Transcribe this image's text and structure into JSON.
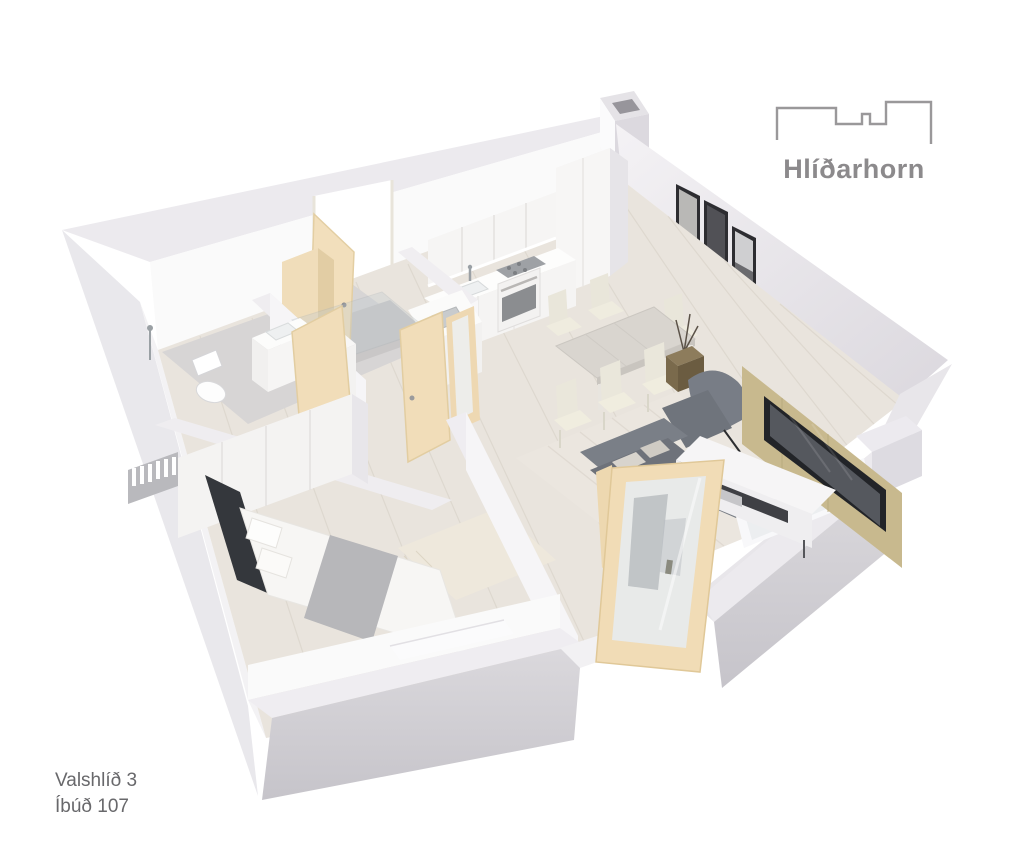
{
  "header": {
    "logo_text": "Hlíðarhorn"
  },
  "footer": {
    "address": "Valshlíð 3",
    "unit": "Íbúð 107"
  },
  "icons": {
    "logo_mark": "building-skyline-outline-icon"
  },
  "palette": {
    "background": "#ffffff",
    "logo_gray": "#8c8a8c",
    "footer_text": "#68686b",
    "wall_white": "#fafafa",
    "wall_top": "#eceaee",
    "wall_outer_shadow": "#c6c4ca",
    "floor_wood": "#e9e4dd",
    "bathroom_tile": "#d7d5d5",
    "door_beige": "#f2debb",
    "sofa_gray": "#6e727a",
    "tv_panel_wood": "#c8b98e",
    "dining_chair_cream": "#ece9dd",
    "art_frame_dark": "#2d2d31"
  }
}
